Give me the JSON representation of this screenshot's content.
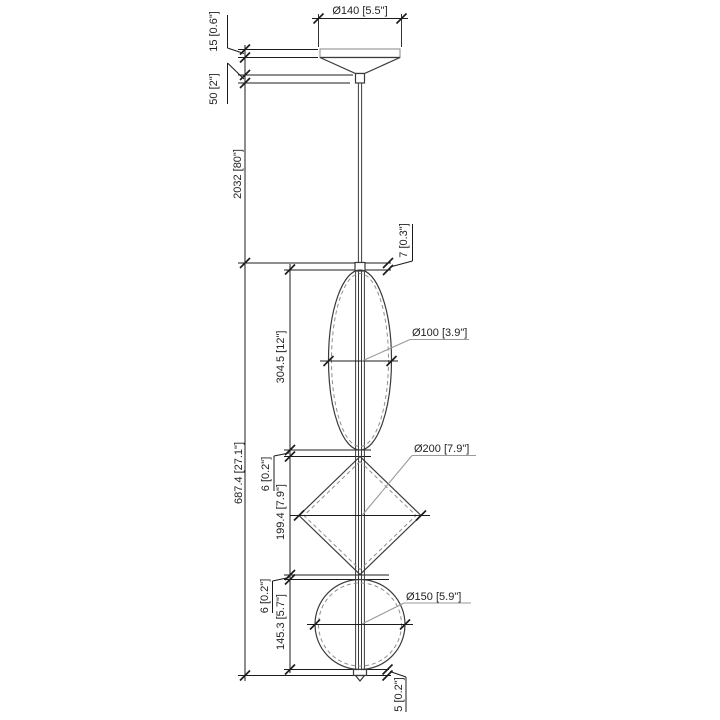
{
  "drawing": {
    "kind": "technical dimension drawing",
    "subject": "pendant light suspension with ellipse, diamond and sphere glass elements",
    "units": "millimetres [inches]",
    "colors": {
      "dimension_lines": "#1c1c1c",
      "object_lines": "#3a3a3a",
      "hidden_dashed_lines": "#8f8f8f",
      "leader_lines": "#9a9a9a",
      "background": "#ffffff"
    }
  },
  "labels": {
    "canopy_diameter": "Ø140 [5.5\"]",
    "canopy_thickness": "15 [0.6\"]",
    "canopy_height": "50 [2\"]",
    "cable_length": "2032 [80\"]",
    "connector_height": "7 [0.3\"]",
    "overall_fixture_height": "687.4 [27.1\"]",
    "ellipse_height": "304.5 [12\"]",
    "ellipse_diameter": "Ø100 [3.9\"]",
    "gap_ellipse_diamond": "6 [0.2\"]",
    "diamond_height": "199.4 [7.9\"]",
    "diamond_diameter": "Ø200 [7.9\"]",
    "gap_diamond_sphere": "6 [0.2\"]",
    "sphere_height": "145.3 [5.7\"]",
    "sphere_diameter": "Ø150 [5.9\"]",
    "finial_height": "5 [0.2\"]"
  }
}
